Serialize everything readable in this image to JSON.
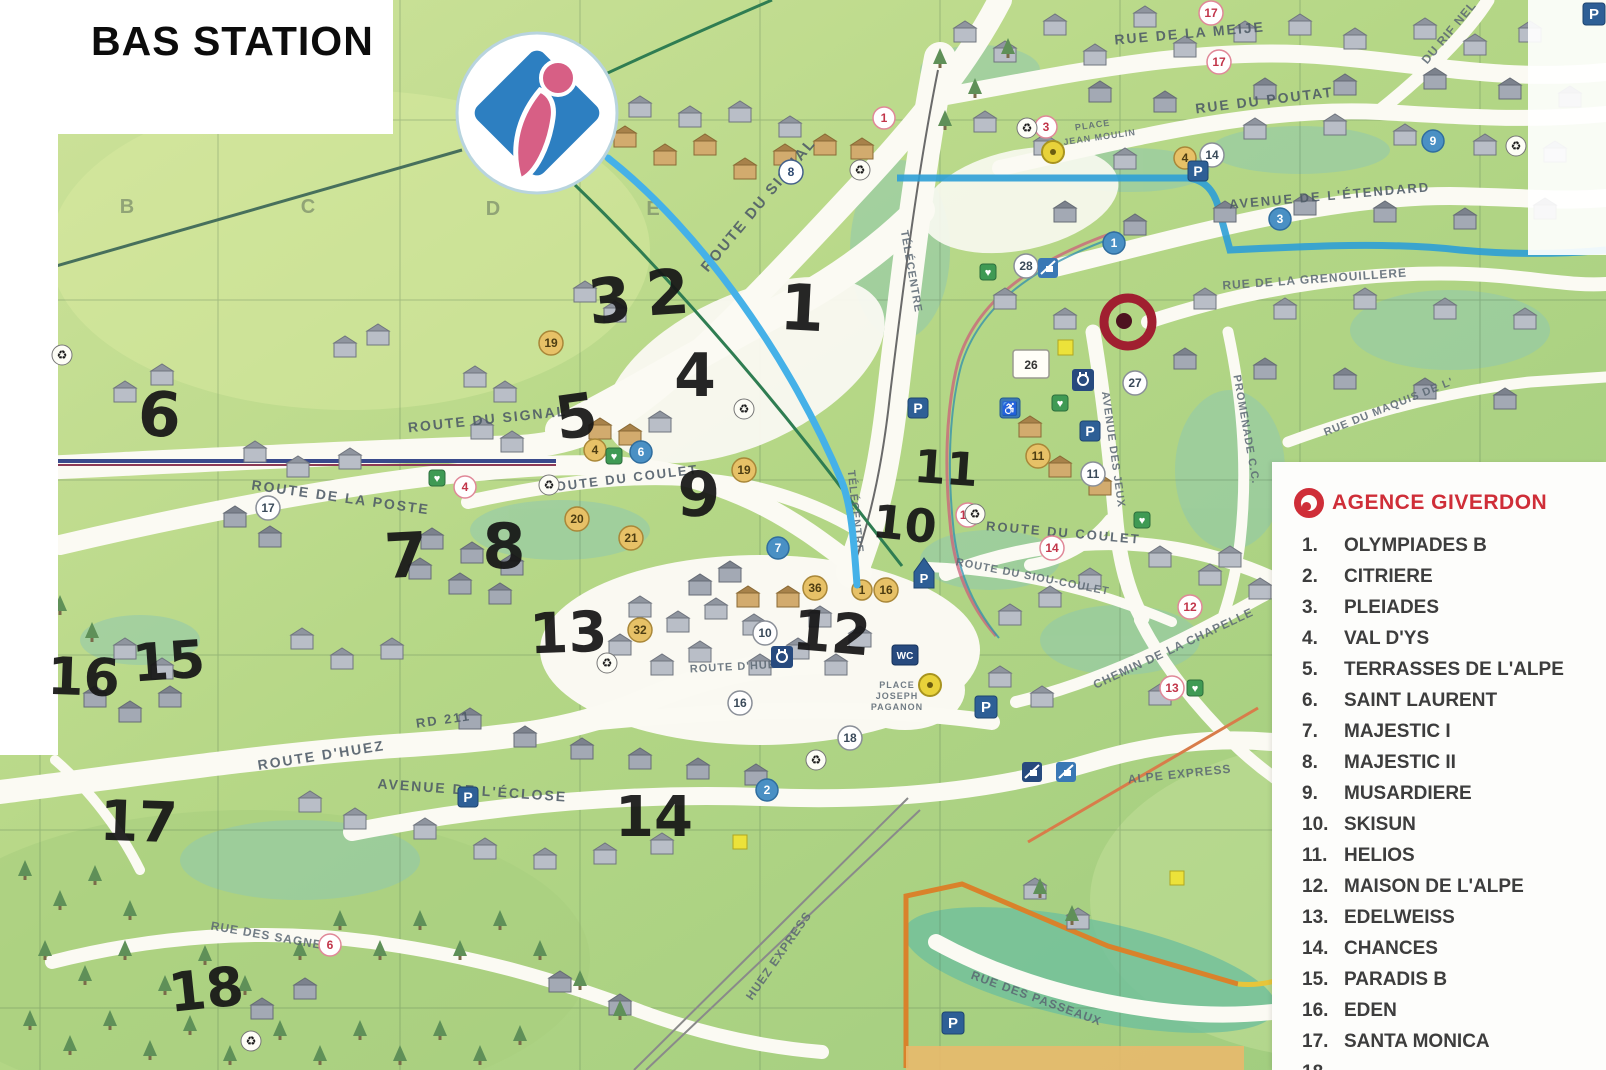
{
  "title": "BAS STATION",
  "grid_letters": [
    "B",
    "C",
    "D",
    "E"
  ],
  "legend": {
    "title": "AGENCE GIVERDON",
    "items": [
      {
        "n": "1.",
        "label": "OLYMPIADES B"
      },
      {
        "n": "2.",
        "label": "CITRIERE"
      },
      {
        "n": "3.",
        "label": "PLEIADES"
      },
      {
        "n": "4.",
        "label": "VAL D'YS"
      },
      {
        "n": "5.",
        "label": "TERRASSES DE L'ALPE"
      },
      {
        "n": "6.",
        "label": "SAINT LAURENT"
      },
      {
        "n": "7.",
        "label": "MAJESTIC I"
      },
      {
        "n": "8.",
        "label": "MAJESTIC II"
      },
      {
        "n": "9.",
        "label": "MUSARDIERE"
      },
      {
        "n": "10.",
        "label": "SKISUN"
      },
      {
        "n": "11.",
        "label": "HELIOS"
      },
      {
        "n": "12.",
        "label": "MAISON DE L'ALPE"
      },
      {
        "n": "13.",
        "label": "EDELWEISS"
      },
      {
        "n": "14.",
        "label": "CHANCES"
      },
      {
        "n": "15.",
        "label": "PARADIS B"
      },
      {
        "n": "16.",
        "label": "EDEN"
      },
      {
        "n": "17.",
        "label": "SANTA MONICA"
      },
      {
        "n": "18.",
        "label": ""
      }
    ]
  },
  "map": {
    "street_labels": [
      "ROUTE DU SIGNAL",
      "ROUTE DU SIGNAL",
      "RUE DE LA MEIJE",
      "RUE DU POUTAT",
      "AVENUE DE L'ÉTENDARD",
      "DU RIF NEL",
      "RUE DE LA GRENOUILLERE",
      "PROMENADE C.C.",
      "RUE DU MAQUIS DE L'",
      "AVENUE DES JEUX",
      "ROUTE DU COULET",
      "ROUTE DU COULET",
      "ROUTE DE LA POSTE",
      "ROUTE DU SIOU-COULET",
      "CHEMIN DE LA CHAPELLE",
      "ROUTE D'HUEZ",
      "RD 211",
      "AVENUE DE L'ÉCLOSE",
      "RUE DES SAGNES",
      "RUE DES PASSEAUX",
      "TÉLÉCENTRE",
      "TÉLÉCENTRE",
      "HUEZ EXPRESS",
      "ALPE EXPRESS",
      "PLACE",
      "JEAN MOULIN",
      "PLACE",
      "JOSEPH",
      "PAGANON",
      "ROUTE D'HUEZ"
    ],
    "badges": [
      "17",
      "17",
      "3",
      "1",
      "8",
      "19",
      "4",
      "14",
      "3",
      "9",
      "1",
      "28",
      "26",
      "27",
      "11",
      "11",
      "4",
      "4",
      "6",
      "20",
      "21",
      "19",
      "7",
      "36",
      "1",
      "16",
      "10",
      "32",
      "2",
      "16",
      "18",
      "15'",
      "14",
      "12",
      "13",
      "6",
      "17"
    ],
    "handwritten": [
      "3",
      "2",
      "1",
      "4",
      "5",
      "6",
      "9",
      "7",
      "8",
      "10",
      "11",
      "13",
      "12",
      "16",
      "15",
      "17",
      "14",
      "18"
    ]
  },
  "icons": {
    "parking": "P",
    "wc": "WC",
    "recycle": "♻",
    "heart": "♥",
    "wheelchair": "♿"
  },
  "colors": {
    "agency_red": "#cf2e38",
    "map_green": "#b8d988",
    "piste_blue": "#45b1e8",
    "marker_red": "#a01f30",
    "handwriting_black": "#161616"
  }
}
